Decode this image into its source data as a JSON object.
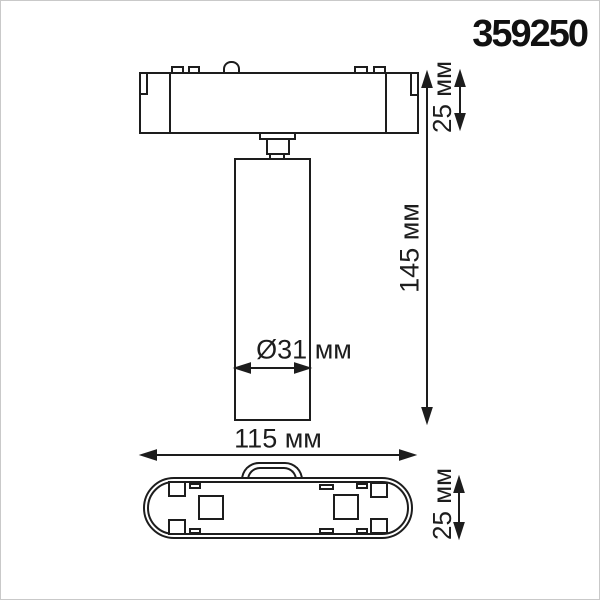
{
  "title": "359250",
  "colors": {
    "line": "#1d1d1d",
    "background": "#ffffff",
    "frame": "#c9c9c9"
  },
  "views": {
    "front": "front view of track spot light (adapter bar with cylindrical lamp body)",
    "bottom": "bottom view of track adapter (stadium outline with contact pads)"
  },
  "dimensions": {
    "adapter_height_label": "25 мм",
    "overall_height_label": "145 мм",
    "diameter_label": "Ø31 мм",
    "width_label": "115 мм",
    "depth_label": "25 мм"
  }
}
